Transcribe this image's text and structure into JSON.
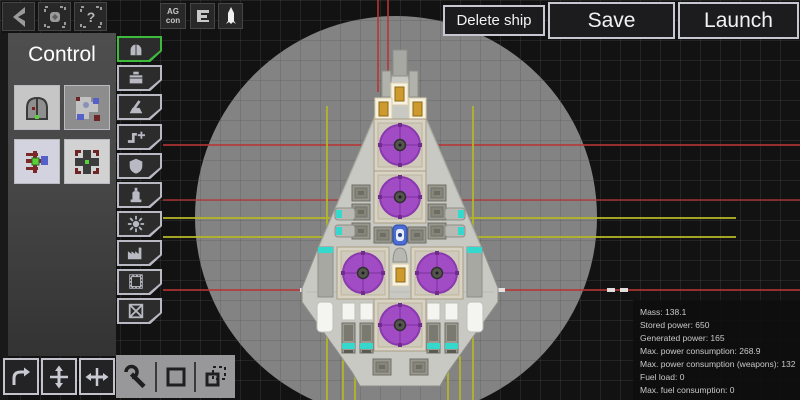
{
  "colors": {
    "accent_green": "#3dbb3d",
    "reactor_purple": "#a14cc4",
    "window_amber": "#ce9a2e",
    "cyan_accent": "#35d8cc",
    "guide_red": "#b83636",
    "guide_yellow": "#b4b428"
  },
  "topbar": {
    "left_buttons": [
      {
        "name": "back"
      },
      {
        "name": "center-view"
      },
      {
        "name": "help",
        "glyph": "?"
      }
    ],
    "mid_buttons": [
      {
        "name": "ag-control",
        "label_top": "AG",
        "label_bottom": "con"
      },
      {
        "name": "stats-toggle"
      },
      {
        "name": "ship-view"
      }
    ],
    "actions": [
      {
        "name": "delete-ship",
        "label": "Delete ship"
      },
      {
        "name": "save",
        "label": "Save"
      },
      {
        "name": "launch",
        "label": "Launch"
      }
    ]
  },
  "category_panel": {
    "title": "Control",
    "parts": [
      {
        "name": "cockpit"
      },
      {
        "name": "control-module"
      },
      {
        "name": "thruster-control"
      },
      {
        "name": "gyroscope"
      }
    ]
  },
  "tool_tabs": [
    {
      "name": "control",
      "selected": true
    },
    {
      "name": "storage",
      "selected": false
    },
    {
      "name": "weapons",
      "selected": false
    },
    {
      "name": "connectors",
      "selected": false
    },
    {
      "name": "shields",
      "selected": false
    },
    {
      "name": "fuel",
      "selected": false
    },
    {
      "name": "power",
      "selected": false
    },
    {
      "name": "production",
      "selected": false
    },
    {
      "name": "hull",
      "selected": false
    },
    {
      "name": "remove",
      "selected": false
    }
  ],
  "transform_tools": [
    {
      "name": "rotate"
    },
    {
      "name": "flip-vertical"
    },
    {
      "name": "flip-horizontal"
    }
  ],
  "edit_tools": [
    {
      "name": "configure"
    },
    {
      "name": "select-area"
    },
    {
      "name": "copy-selection"
    }
  ],
  "stats_panel": {
    "rows": [
      {
        "label": "Mass",
        "value": "138.1"
      },
      {
        "label": "Stored power",
        "value": "650"
      },
      {
        "label": "Generated power",
        "value": "165"
      },
      {
        "label": "Max. power consumption",
        "value": "268.9"
      },
      {
        "label": "Max. power consumption (weapons)",
        "value": "132"
      },
      {
        "label": "Fuel load",
        "value": "0"
      },
      {
        "label": "Max. fuel consumption",
        "value": "0"
      }
    ]
  }
}
